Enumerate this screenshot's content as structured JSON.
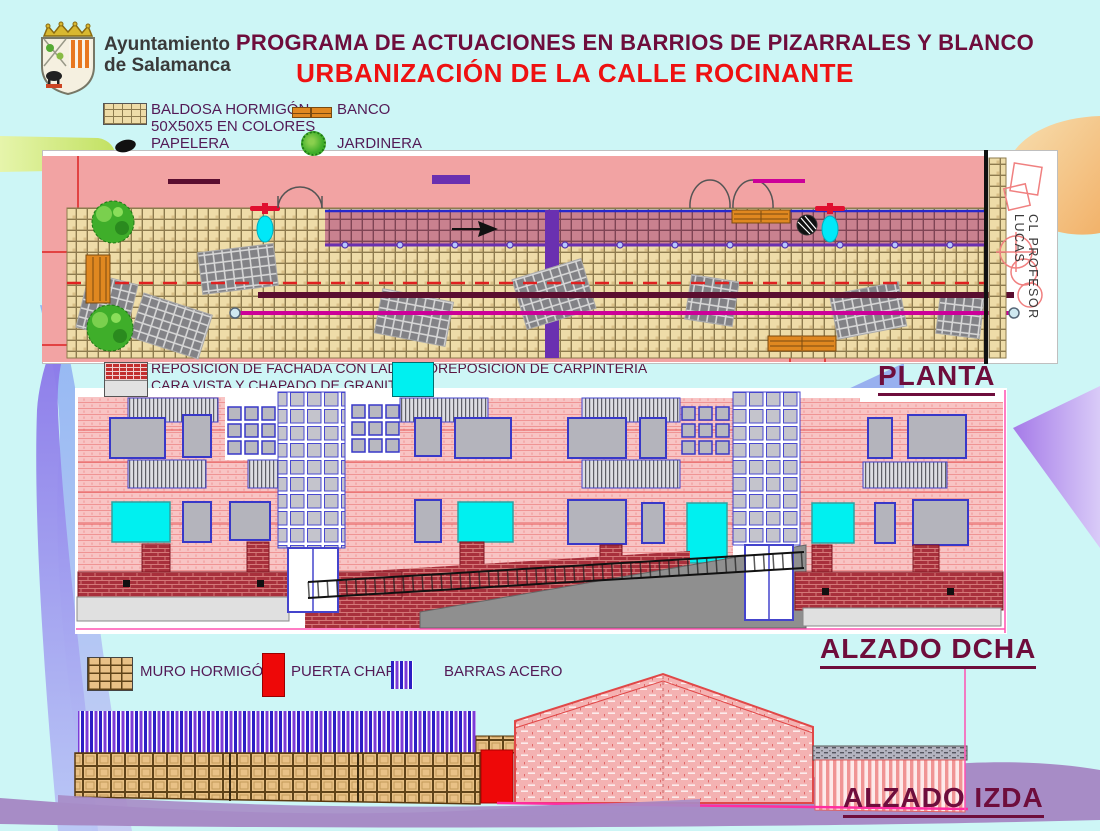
{
  "slide": {
    "org_line1": "Ayuntamiento",
    "org_line2": "de Salamanca",
    "title_line1": "PROGRAMA DE ACTUACIONES EN BARRIOS DE PIZARRALES Y BLANCO",
    "title_line2": "URBANIZACIÓN DE LA CALLE ROCINANTE"
  },
  "legend_top": {
    "baldosa_line1": "BALDOSA HORMIGÓN",
    "baldosa_line2": "50X50X5 EN COLORES",
    "banco": "BANCO",
    "papelera": "PAPELERA",
    "jardinera": "JARDINERA"
  },
  "plan": {
    "label": "PLANTA",
    "street_label": "CL PROFESOR LUCAS",
    "legend": {
      "saneamiento": "SANEAMIENTO PVCØ315",
      "canalizacion": "CANALIZACIÓN SUBTERRÁNEA",
      "abastecimiento": "ABASTECIMIENTO  PEØ50"
    }
  },
  "elevation_right": {
    "label": "ALZADO DCHA",
    "legend": {
      "fachada_line1": "REPOSICIÓN DE FACHADA  CON LADRILLO",
      "fachada_line2": "CARA VISTA Y CHAPADO  DE GRANITO",
      "carpinteria": "REPOSICIÓN DE CARPINTERIA"
    }
  },
  "elevation_left": {
    "label": "ALZADO IZDA",
    "legend": {
      "muro": "MURO HORMIGÓN",
      "puerta": "PUERTA CHAPA",
      "barras": "BARRAS ACERO"
    }
  },
  "colors": {
    "background": "#cdf6f6",
    "title_maroon": "#6e0d3c",
    "title_red": "#ee1111",
    "legend_text": "#531a56",
    "plan_pink": "#f2a3a3",
    "saneamiento_line": "#5a0e30",
    "canalizacion_purple": "#6a30b0",
    "abastecimiento_magenta": "#cc0099",
    "carpinteria_cyan": "#00f0f0",
    "puerta_red": "#ee0808",
    "wave_purple": "#a78cc6"
  }
}
